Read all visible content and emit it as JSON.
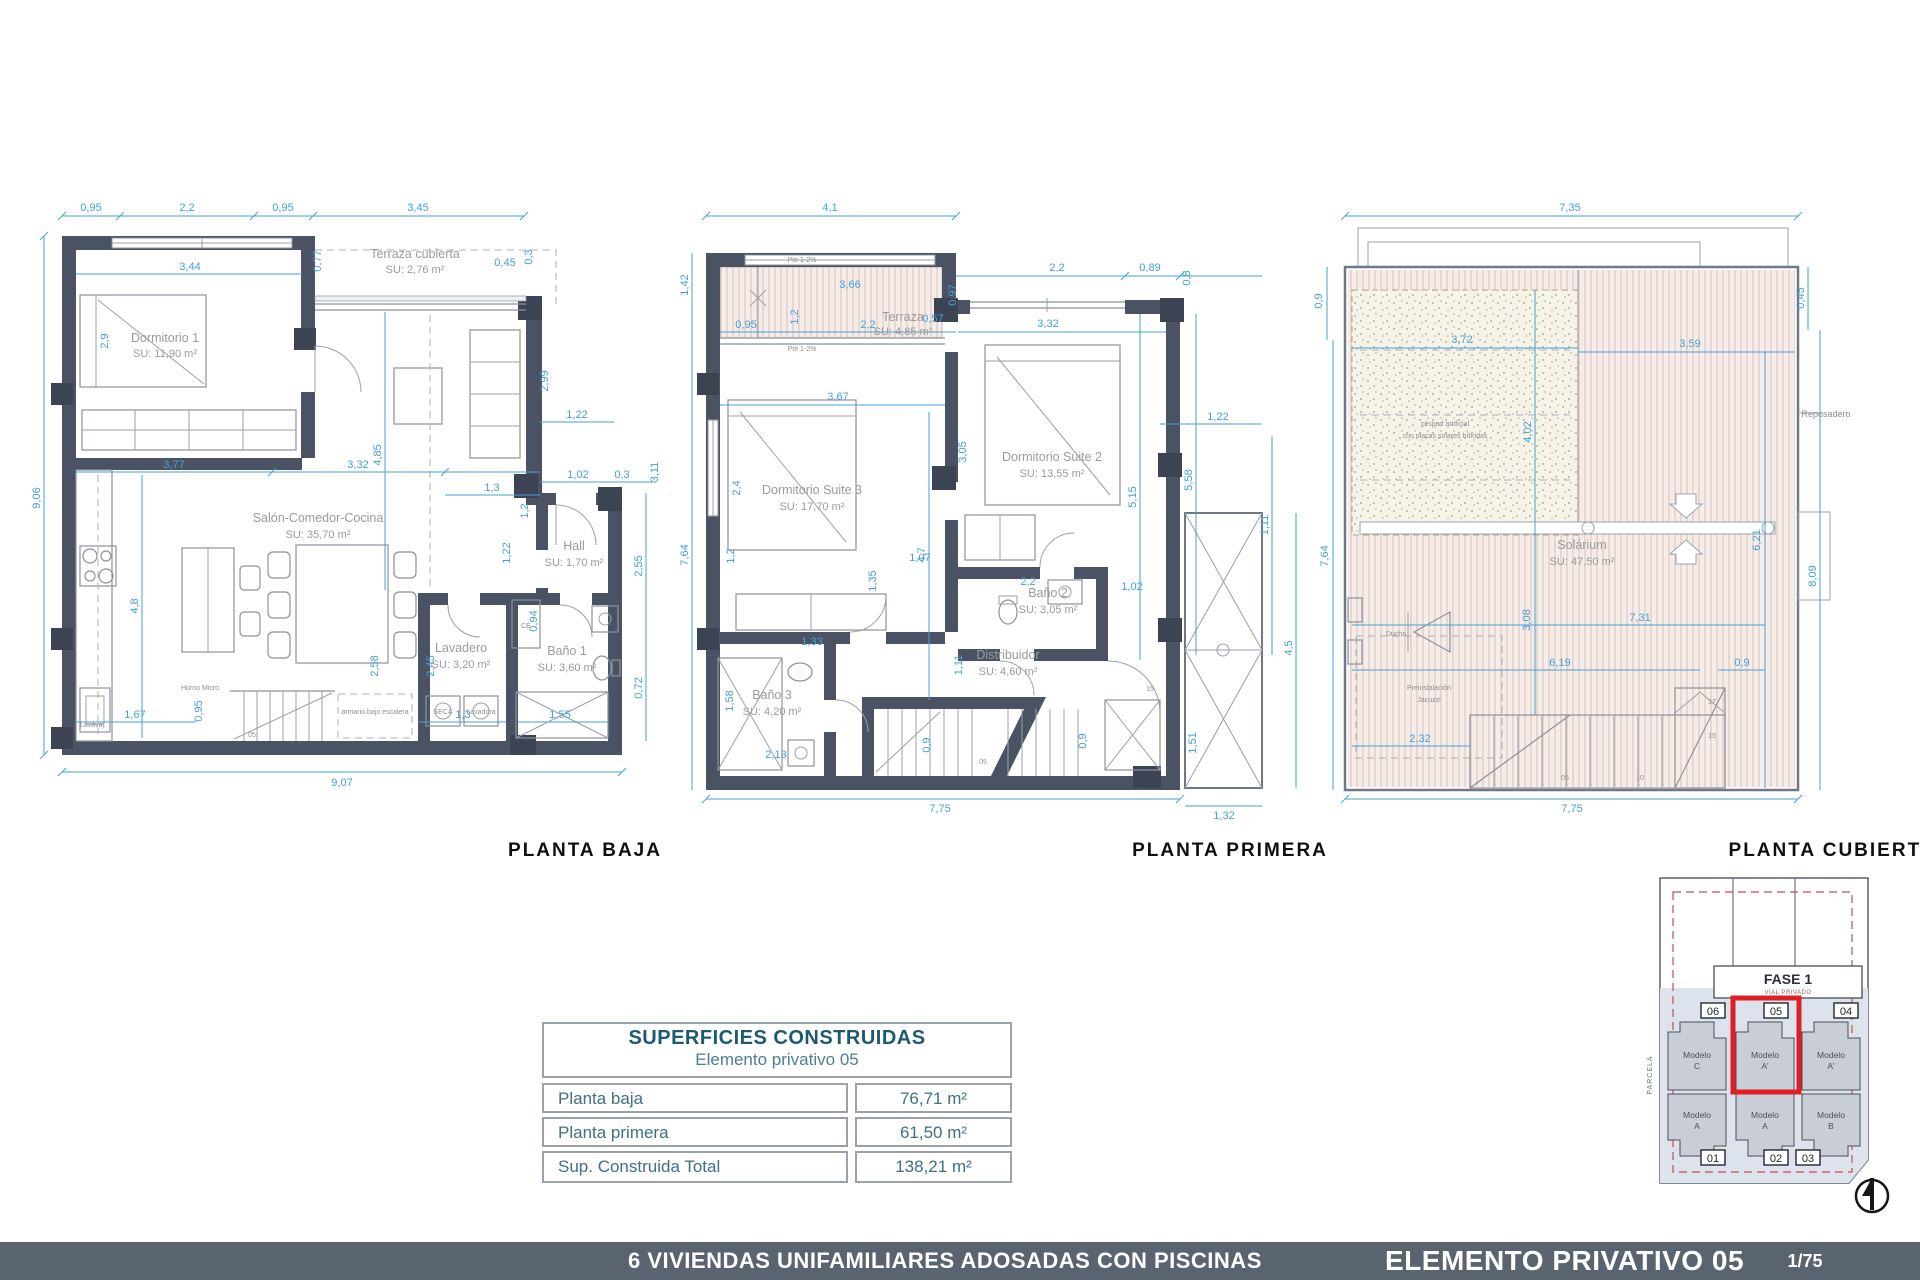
{
  "titles": {
    "baja": "PLANTA BAJA",
    "primera": "PLANTA PRIMERA",
    "cubierta": "PLANTA CUBIERTA"
  },
  "footer": {
    "project": "6 VIVIENDAS UNIFAMILIARES ADOSADAS CON PISCINAS",
    "sheet": "ELEMENTO PRIVATIVO 05",
    "scale": "1/75"
  },
  "table": {
    "title": "SUPERFICIES CONSTRUIDAS",
    "subtitle": "Elemento privativo 05",
    "rows": [
      {
        "label": "Planta baja",
        "value": "76,71 m²"
      },
      {
        "label": "Planta primera",
        "value": "61,50 m²"
      },
      {
        "label": "Sup. Construida Total",
        "value": "138,21 m²"
      }
    ]
  },
  "minimap": {
    "fase": "FASE 1",
    "vial": "VIAL PRIVADO",
    "parcela": "PARCELA",
    "plots_top": [
      "06",
      "05",
      "04"
    ],
    "plots_bottom": [
      "01",
      "02",
      "03"
    ],
    "models_top": [
      {
        "name": "Modelo",
        "variant": "C"
      },
      {
        "name": "Modelo",
        "variant": "A'"
      },
      {
        "name": "Modelo",
        "variant": "A'"
      }
    ],
    "models_bottom": [
      {
        "name": "Modelo",
        "variant": "A"
      },
      {
        "name": "Modelo",
        "variant": "A"
      },
      {
        "name": "Modelo",
        "variant": "B"
      }
    ],
    "highlighted_plot": "05"
  },
  "colors": {
    "wall": "#4a5264",
    "dimension_blue": "#45a1d6",
    "accent_red": "#e01e25",
    "footer_bar": "#5a6370",
    "table_teal": "#1c5a74"
  },
  "plans": {
    "baja": {
      "rooms": [
        {
          "name": "Dormitorio 1",
          "su": "SU: 11,90 m²"
        },
        {
          "name": "Terraza cubierta",
          "su": "SU: 2,76 m²"
        },
        {
          "name": "Salón-Comedor-Cocina",
          "su": "SU: 35,70 m²"
        },
        {
          "name": "Hall",
          "su": "SU: 1,70 m²"
        },
        {
          "name": "Lavadero",
          "su": "SU: 3,20 m²"
        },
        {
          "name": "Baño 1",
          "su": "SU: 3,60 m²"
        }
      ],
      "small_labels": [
        "Horno Micro",
        "armario bajo escalera",
        "SECA",
        "Lavadora",
        "Lavavaj.",
        "CE",
        "05"
      ],
      "dims": [
        "0,95",
        "2,2",
        "0,95",
        "3,45",
        "0,45",
        "3,44",
        "0,77",
        "0,3",
        "9,06",
        "2,9",
        "2,99",
        "1,22",
        "3,11",
        "1,02",
        "0,3",
        "3,77",
        "3,32",
        "1,3",
        "4,85",
        "1,2",
        "1,22",
        "2,55",
        "0,94",
        "0,72",
        "4,8",
        "2,58",
        "2,45",
        "1,67",
        "0,95",
        "1,3",
        "1,55",
        "9,07"
      ]
    },
    "primera": {
      "rooms": [
        {
          "name": "Terraza",
          "su": "SU: 4,85 m²"
        },
        {
          "name": "Dormitorio Suite 3",
          "su": "SU: 17,70 m²"
        },
        {
          "name": "Dormitorio Suite 2",
          "su": "SU: 13,55 m²"
        },
        {
          "name": "Baño 2",
          "su": "SU: 3,05 m²"
        },
        {
          "name": "Baño 3",
          "su": "SU: 4,20 m²"
        },
        {
          "name": "Distribuidor",
          "su": "SU: 4,60 m²"
        }
      ],
      "small_labels": [
        "Pte 1-2%",
        "Pte 1-2%",
        "05",
        "15"
      ],
      "dims": [
        "4,1",
        "1,42",
        "7,64",
        "3,66",
        "0,95",
        "1,2",
        "2,2",
        "0,57",
        "0,97",
        "2,2",
        "0,89",
        "0,8",
        "3,32",
        "3,67",
        "3,05",
        "2,4",
        "4,7",
        "5,15",
        "5,58",
        "1,22",
        "1,11",
        "1,02",
        "1,07",
        "2,2",
        "1,33",
        "1,35",
        "1,2",
        "1,58",
        "2,13",
        "1,11",
        "0,9",
        "0,9",
        "7,75",
        "1,32",
        "4,5",
        "1,51"
      ]
    },
    "cubierta": {
      "rooms": [
        {
          "name": "Solárium",
          "su": "SU: 47,50 m²"
        }
      ],
      "labels": {
        "cesped1": "césped artificial",
        "cesped2": "con placas solares híbridas",
        "jacuzzi1": "Preinstalación",
        "jacuzzi2": "Jacuzzi",
        "ducha": "Ducha",
        "reposadero": "Reposadero"
      },
      "stair_numbers": [
        "05",
        "10",
        "15",
        "17"
      ],
      "dims": [
        "7,35",
        "0,9",
        "7,64",
        "0,45",
        "8,09",
        "3,72",
        "3,59",
        "4,02",
        "6,21",
        "3,08",
        "7,31",
        "6,19",
        "0,9",
        "2,32",
        "7,75"
      ]
    }
  }
}
